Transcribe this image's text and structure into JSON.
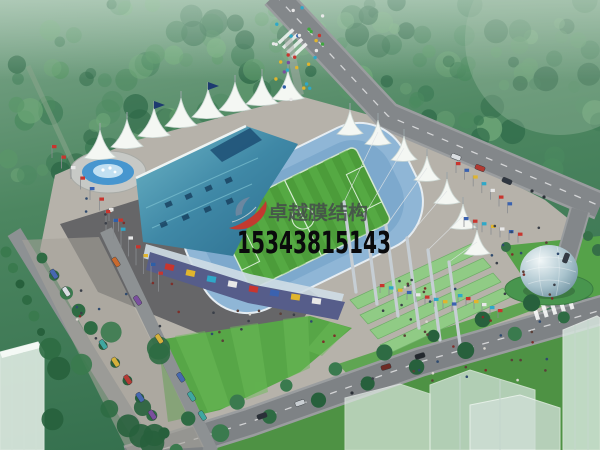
{
  "scene": {
    "type": "architectural-rendering",
    "subject": "aerial view of a membrane-roof stadium complex with plaza, fountain, roads, parking avenue and glass dome"
  },
  "watermark": {
    "brand": "卓越膜结构",
    "phone": "15343815143",
    "logo_icon": "red-swoosh-logo",
    "brand_color": "#44484c",
    "phone_color": "#0a0a0c"
  },
  "palette": {
    "forest_green": "#3c7a54",
    "lawn_green": "#57a647",
    "field_green": "#4c9c3a",
    "roof_teal": "#3f88a6",
    "membrane_white": "#f4f7f3",
    "stand_blue": "#8fb6d6",
    "plaza_gray": "#b6b2aa",
    "road_gray": "#83878a",
    "shadow_gray": "#4f5156",
    "fountain_water_blue": "#4796cf",
    "sphere_silver": "#a9c3cd",
    "ad_band_purple": "#565d8a"
  }
}
